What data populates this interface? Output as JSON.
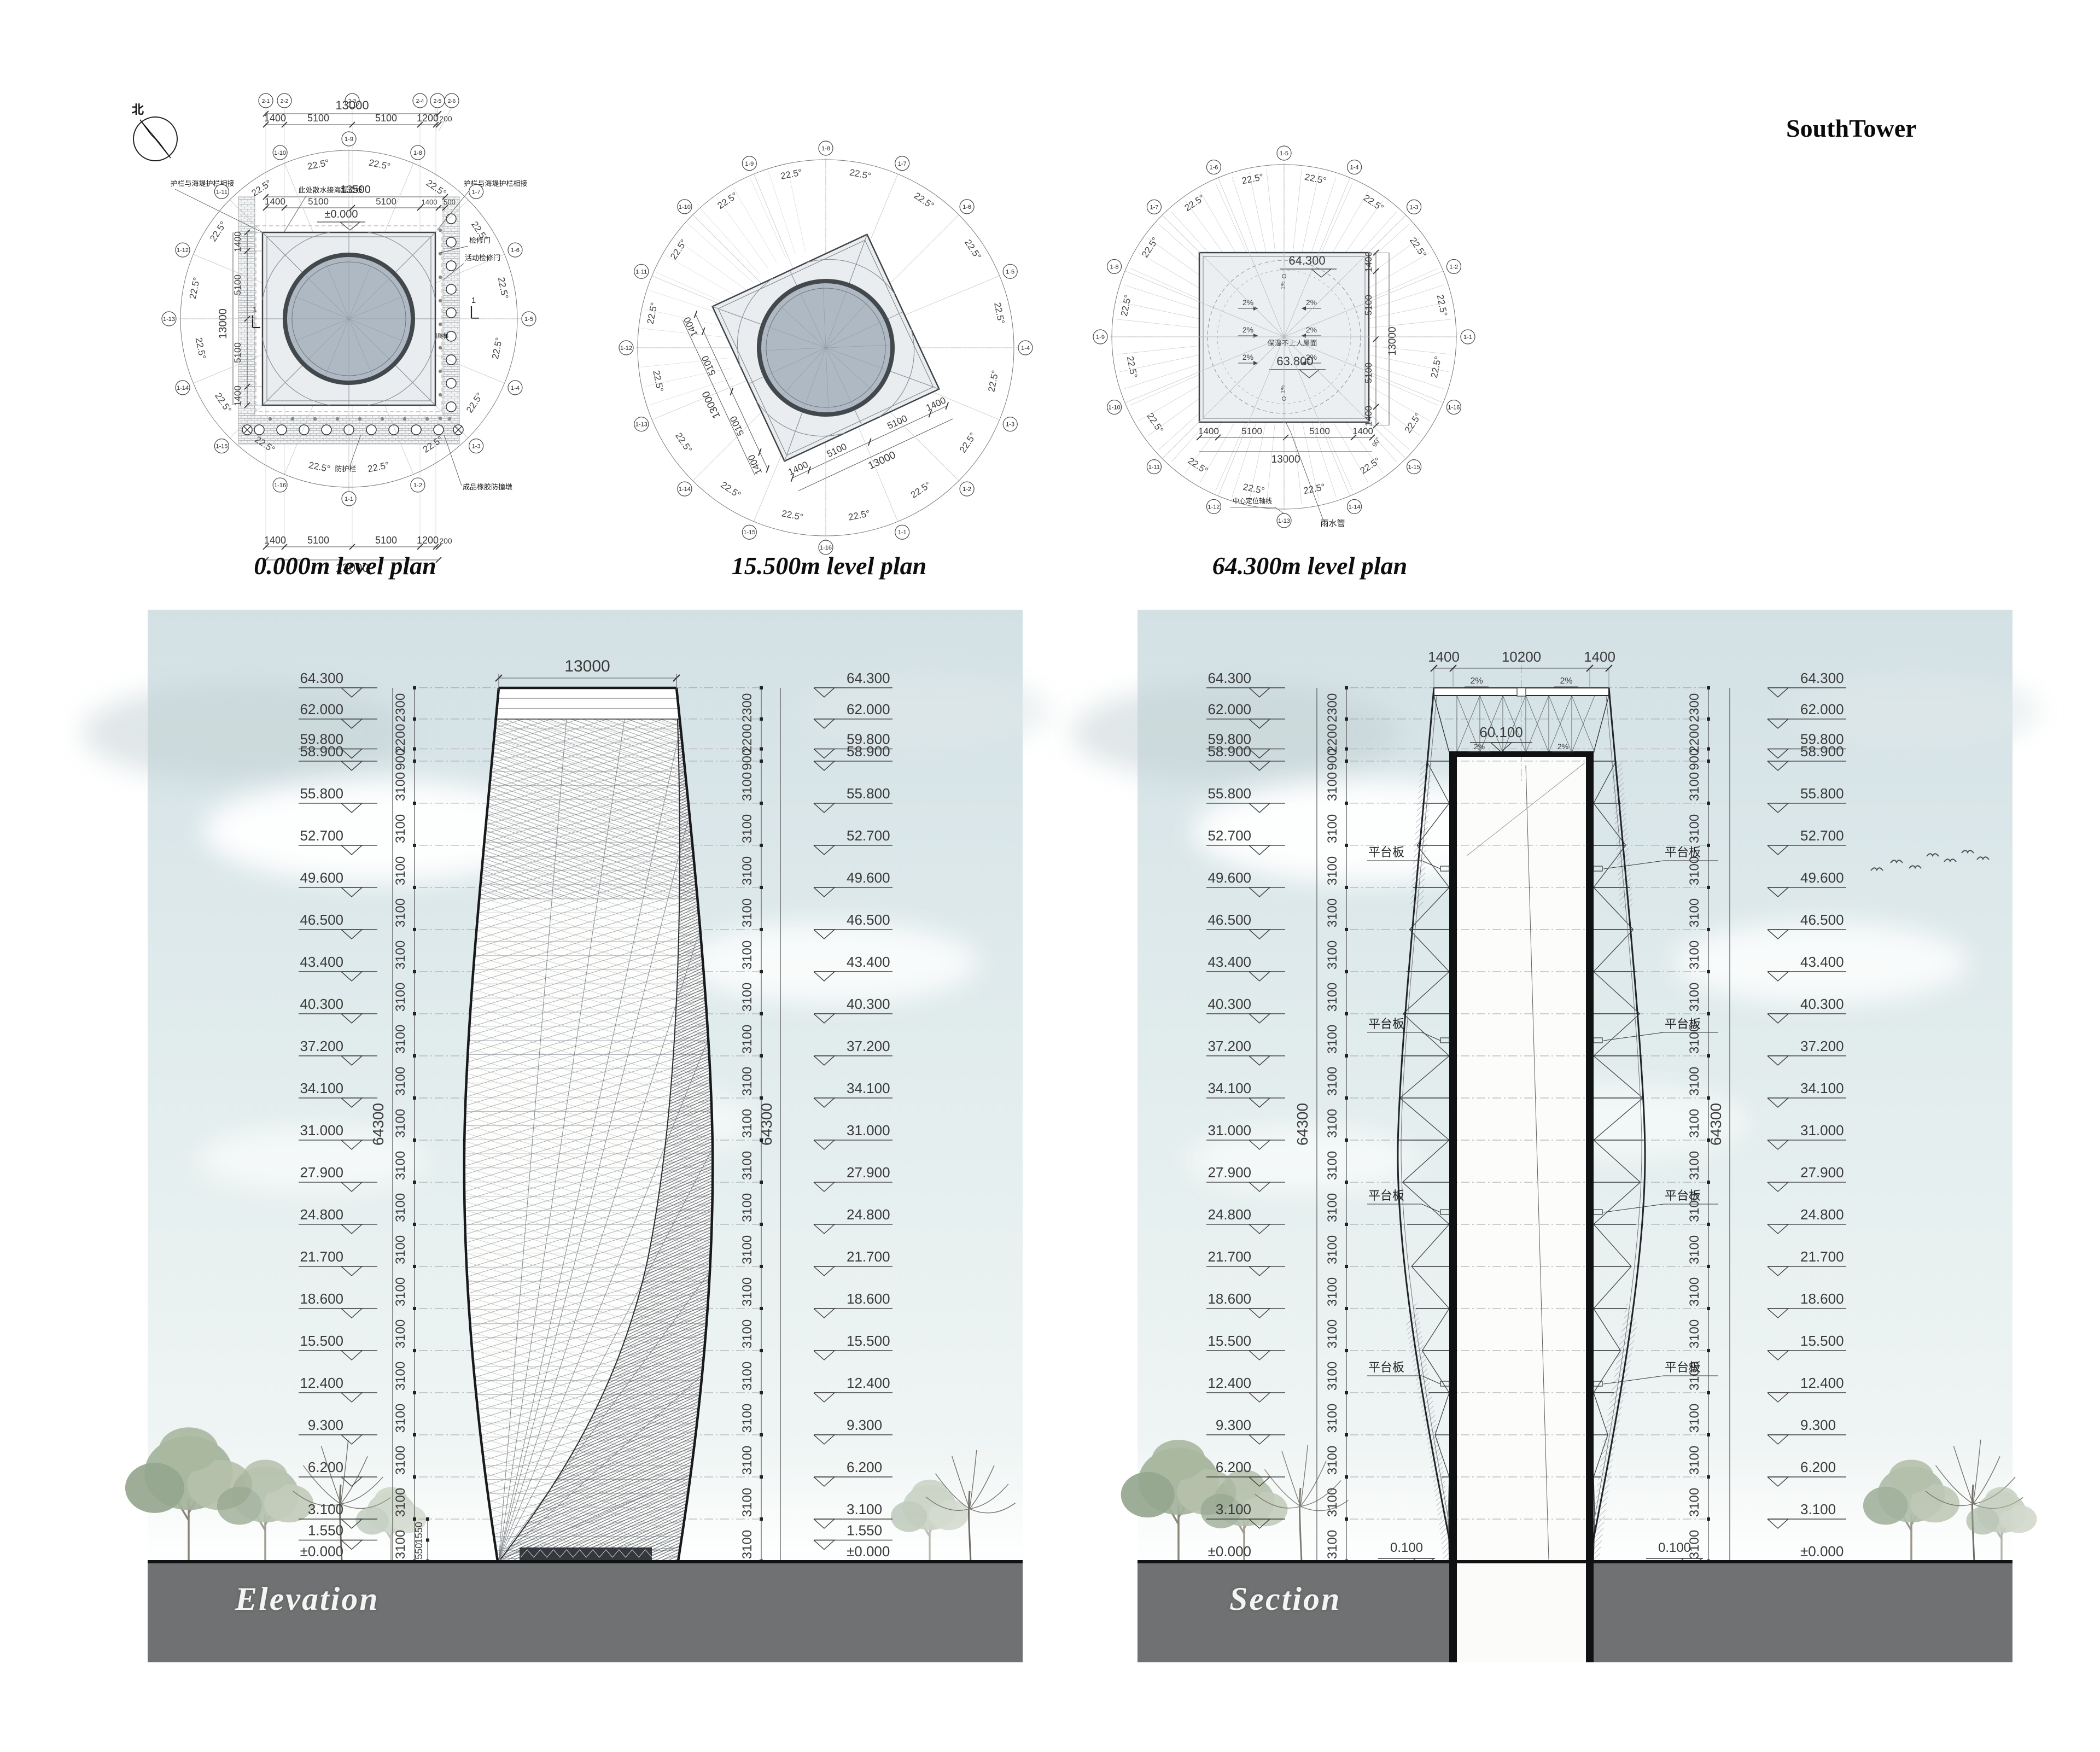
{
  "page": {
    "title": "SouthTower"
  },
  "compass": {
    "north": "北"
  },
  "plans": {
    "captions": [
      "0.000m level plan",
      "15.500m level plan",
      "64.300m level plan"
    ],
    "angle": "22.5°",
    "right_angle": "90°",
    "grid_top": [
      "2-1",
      "2-2",
      "2-3",
      "2-4",
      "2-5",
      "2-6"
    ],
    "bubbles": [
      "1-1",
      "1-2",
      "1-3",
      "1-4",
      "1-5",
      "1-6",
      "1-7",
      "1-8",
      "1-9",
      "1-10",
      "1-11",
      "1-12",
      "1-13",
      "1-14",
      "1-15",
      "1-16"
    ],
    "area_note": "过风面积75.4平方米",
    "plan1": {
      "level": "±0.000",
      "inner_level": "0.100",
      "slope": "1%",
      "dim_total": "13000",
      "dims": [
        "1400",
        "5100",
        "5100",
        "1200",
        "200"
      ],
      "dim2_total": "13500",
      "dims2": [
        "1400",
        "5100",
        "5100",
        "1400",
        "500"
      ],
      "side_total": "13000",
      "side_dims": [
        "1400",
        "5100",
        "5100",
        "1400"
      ],
      "bottom_total": "13000",
      "bottom_dims": [
        "1400",
        "5100",
        "5100",
        "1200",
        "200"
      ],
      "notes": {
        "rail_left": "护栏与海堤护栏相接",
        "rail_right": "护栏与海堤护栏相接",
        "drain": "此处散水接海堤边线",
        "door": "检修门",
        "door2": "活动检修门",
        "guard": "防护栏",
        "bumper": "成品橡胶防撞墩",
        "ladder": "钢爬梯",
        "cut": "1"
      }
    },
    "plan2": {
      "edge_total": "13000",
      "edge_dims": [
        "1400",
        "5100",
        "5100",
        "1400"
      ]
    },
    "plan3": {
      "level_high": "64.300",
      "level_low": "63.800",
      "slope": "2%",
      "slope_minor": "1%",
      "roof_note": "保温不上人屋面",
      "bottom_total": "13000",
      "bottom_dims": [
        "1400",
        "5100",
        "5100",
        "1400"
      ],
      "side_total": "13000",
      "side_dims": [
        "1400",
        "5100",
        "5100",
        "1400"
      ],
      "notes": {
        "rain": "雨水管",
        "axis": "中心定位轴线"
      }
    }
  },
  "elevation": {
    "caption": "Elevation",
    "top_dim": "13000",
    "overall": "64300",
    "levels": [
      {
        "label": "64.300",
        "mm": 64300
      },
      {
        "label": "62.000",
        "mm": 62000
      },
      {
        "label": "59.800",
        "mm": 59800
      },
      {
        "label": "58.900",
        "mm": 58900
      },
      {
        "label": "55.800",
        "mm": 55800
      },
      {
        "label": "52.700",
        "mm": 52700
      },
      {
        "label": "49.600",
        "mm": 49600
      },
      {
        "label": "46.500",
        "mm": 46500
      },
      {
        "label": "43.400",
        "mm": 43400
      },
      {
        "label": "40.300",
        "mm": 40300
      },
      {
        "label": "37.200",
        "mm": 37200
      },
      {
        "label": "34.100",
        "mm": 34100
      },
      {
        "label": "31.000",
        "mm": 31000
      },
      {
        "label": "27.900",
        "mm": 27900
      },
      {
        "label": "24.800",
        "mm": 24800
      },
      {
        "label": "21.700",
        "mm": 21700
      },
      {
        "label": "18.600",
        "mm": 18600
      },
      {
        "label": "15.500",
        "mm": 15500
      },
      {
        "label": "12.400",
        "mm": 12400
      },
      {
        "label": "9.300",
        "mm": 9300
      },
      {
        "label": "6.200",
        "mm": 6200
      },
      {
        "label": "3.100",
        "mm": 3100
      },
      {
        "label": "1.550",
        "mm": 1550
      },
      {
        "label": "±0.000",
        "mm": 0
      }
    ],
    "segments": [
      "2300",
      "2200",
      "900",
      "3100",
      "3100",
      "3100",
      "3100",
      "3100",
      "3100",
      "3100",
      "3100",
      "3100",
      "3100",
      "3100",
      "3100",
      "3100",
      "3100",
      "3100",
      "3100",
      "3100",
      "3100",
      "3100"
    ],
    "base_segs": [
      "1550",
      "1550"
    ]
  },
  "section": {
    "caption": "Section",
    "top_dims": [
      "1400",
      "10200",
      "1400"
    ],
    "overall": "64300",
    "inner_level": "60.100",
    "base_level": "0.100",
    "platform": "平台板",
    "slope": "2%",
    "levels": [
      {
        "label": "64.300",
        "mm": 64300
      },
      {
        "label": "62.000",
        "mm": 62000
      },
      {
        "label": "59.800",
        "mm": 59800
      },
      {
        "label": "58.900",
        "mm": 58900
      },
      {
        "label": "55.800",
        "mm": 55800
      },
      {
        "label": "52.700",
        "mm": 52700
      },
      {
        "label": "49.600",
        "mm": 49600
      },
      {
        "label": "46.500",
        "mm": 46500
      },
      {
        "label": "43.400",
        "mm": 43400
      },
      {
        "label": "40.300",
        "mm": 40300
      },
      {
        "label": "37.200",
        "mm": 37200
      },
      {
        "label": "34.100",
        "mm": 34100
      },
      {
        "label": "31.000",
        "mm": 31000
      },
      {
        "label": "27.900",
        "mm": 27900
      },
      {
        "label": "24.800",
        "mm": 24800
      },
      {
        "label": "21.700",
        "mm": 21700
      },
      {
        "label": "18.600",
        "mm": 18600
      },
      {
        "label": "15.500",
        "mm": 15500
      },
      {
        "label": "12.400",
        "mm": 12400
      },
      {
        "label": "9.300",
        "mm": 9300
      },
      {
        "label": "6.200",
        "mm": 6200
      },
      {
        "label": "3.100",
        "mm": 3100
      },
      {
        "label": "±0.000",
        "mm": 0
      }
    ],
    "segments": [
      "2300",
      "2200",
      "900",
      "3100",
      "3100",
      "3100",
      "3100",
      "3100",
      "3100",
      "3100",
      "3100",
      "3100",
      "3100",
      "3100",
      "3100",
      "3100",
      "3100",
      "3100",
      "3100",
      "3100",
      "3100",
      "3100"
    ]
  }
}
